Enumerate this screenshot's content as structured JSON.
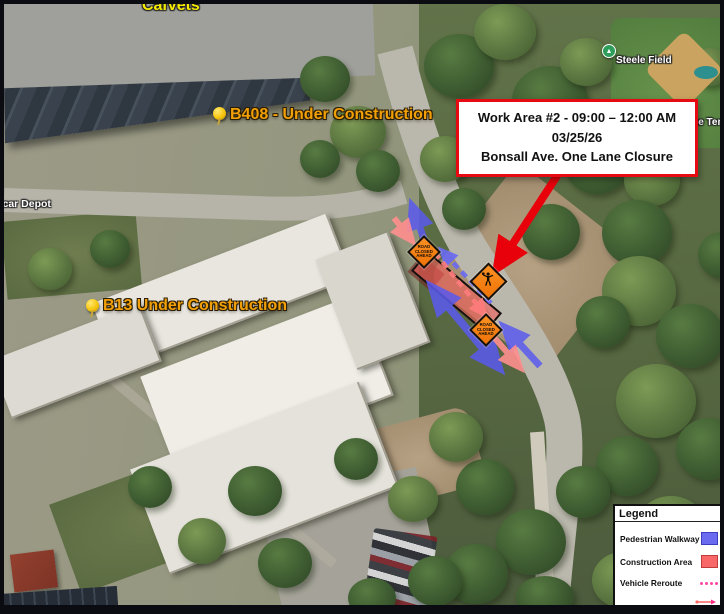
{
  "callout": {
    "line1": "Work Area #2 - 09:00 – 12:00 AM",
    "line2": "03/25/26",
    "line3": "Bonsall Ave. One Lane Closure"
  },
  "labels": {
    "b408": "B408 - Under Construction",
    "b13": "B13 Under Construction"
  },
  "places": {
    "calvets": "CalVets",
    "steele_field": "Steele Field",
    "the_ten": "The Ten",
    "car_depot": "tcar Depot"
  },
  "signs": {
    "road_closed": "ROAD\nCLOSED\nAHEAD"
  },
  "legend": {
    "title": "Legend",
    "items": [
      {
        "label": "Pedestrian Walkway",
        "swatch": "blue-rect"
      },
      {
        "label": "Construction Area",
        "swatch": "red-rect"
      },
      {
        "label": "Vehicle Reroute",
        "swatch": "pink-dots"
      },
      {
        "label": "Vehicle Direction",
        "swatch": "dual-arrows"
      }
    ]
  },
  "colors": {
    "pedestrian_walkway_blue": "#5a5aee",
    "construction_area_red": "#f86a68",
    "vehicle_reroute_pink": "#ff47a3",
    "vehicle_direction_pink": "#ff8f8f",
    "callout_border_red": "#e60b12",
    "annotation_arrow_red": "#e8000b",
    "sign_orange": "#f07f13",
    "pin_label_orange": "#f2a007"
  }
}
